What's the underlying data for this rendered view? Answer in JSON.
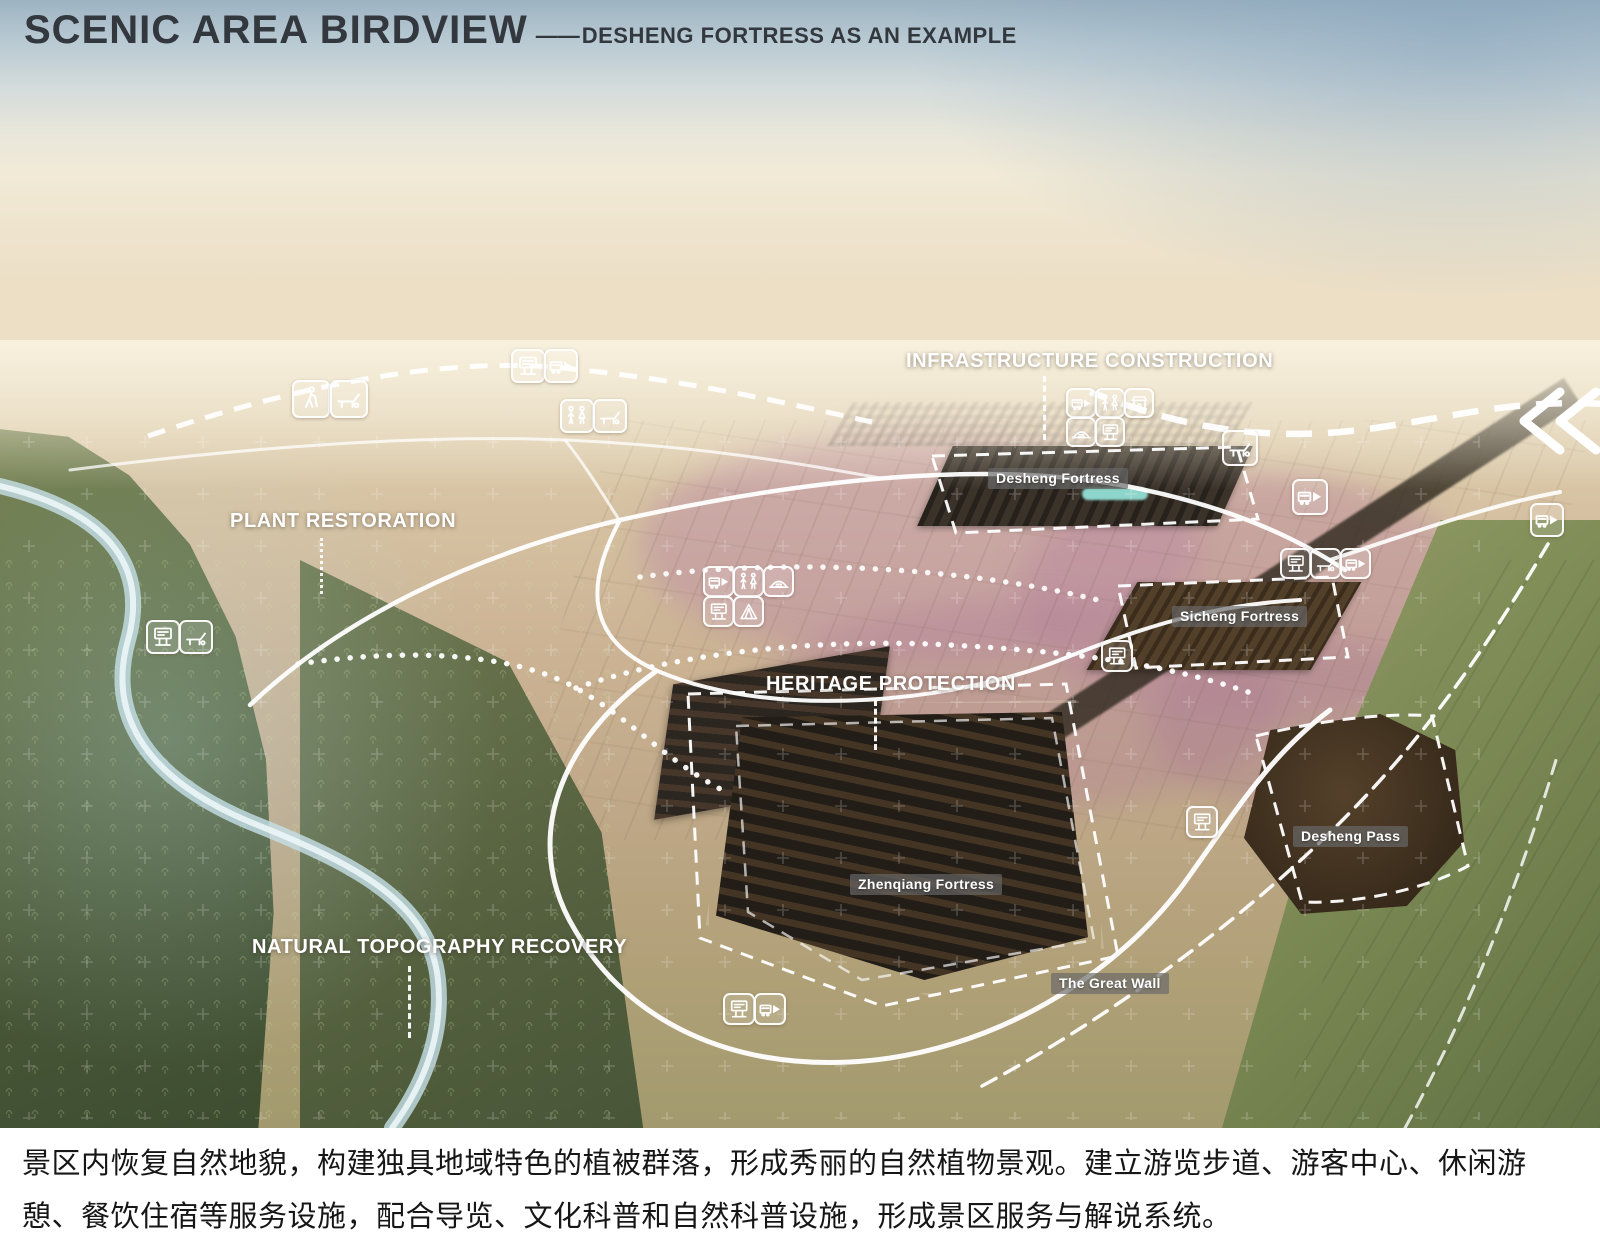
{
  "header": {
    "title": "SCENIC AREA BIRDVIEW",
    "separator": "——",
    "subtitle": "DESHENG FORTRESS AS AN EXAMPLE"
  },
  "zones": {
    "infrastructure": "INFRASTRUCTURE CONSTRUCTION",
    "plant": "PLANT RESTORATION",
    "heritage": "HERITAGE PROTECTION",
    "topography": "NATURAL TOPOGRAPHY RECOVERY"
  },
  "places": {
    "desheng_fortress": "Desheng Fortress",
    "sicheng_fortress": "Sicheng Fortress",
    "zhenqiang_fortress": "Zhenqiang Fortress",
    "desheng_pass": "Desheng Pass",
    "great_wall": "The Great Wall"
  },
  "caption": {
    "text": "景区内恢复自然地貌，构建独具地域特色的植被群落，形成秀丽的自然植物景观。建立游览步道、游客中心、休闲游憩、餐饮住宿等服务设施，配合导览、文化科普和自然科普设施，形成景区服务与解说系统。"
  },
  "icons": {
    "shuttle-bus-icon": "bus with right arrow (shuttle route)",
    "toilet-icon": "man and woman figures (restroom)",
    "lounge-chair-icon": "deck chair (rest area)",
    "info-sign-icon": "interpretation sign board",
    "camp-icon": "tent (camping)",
    "shop-icon": "storefront with awning (services)",
    "viewing-mound-icon": "mound with steps (viewing platform)",
    "hiking-icon": "walking hiker (trail)"
  },
  "colors": {
    "title_text": "#33383e",
    "zone_label_text": "#ffffff",
    "place_tag_bg": "rgba(105,105,105,0.68)",
    "route_line": "#ffffff",
    "caption_text": "#161616",
    "caption_bg": "#ffffff"
  }
}
